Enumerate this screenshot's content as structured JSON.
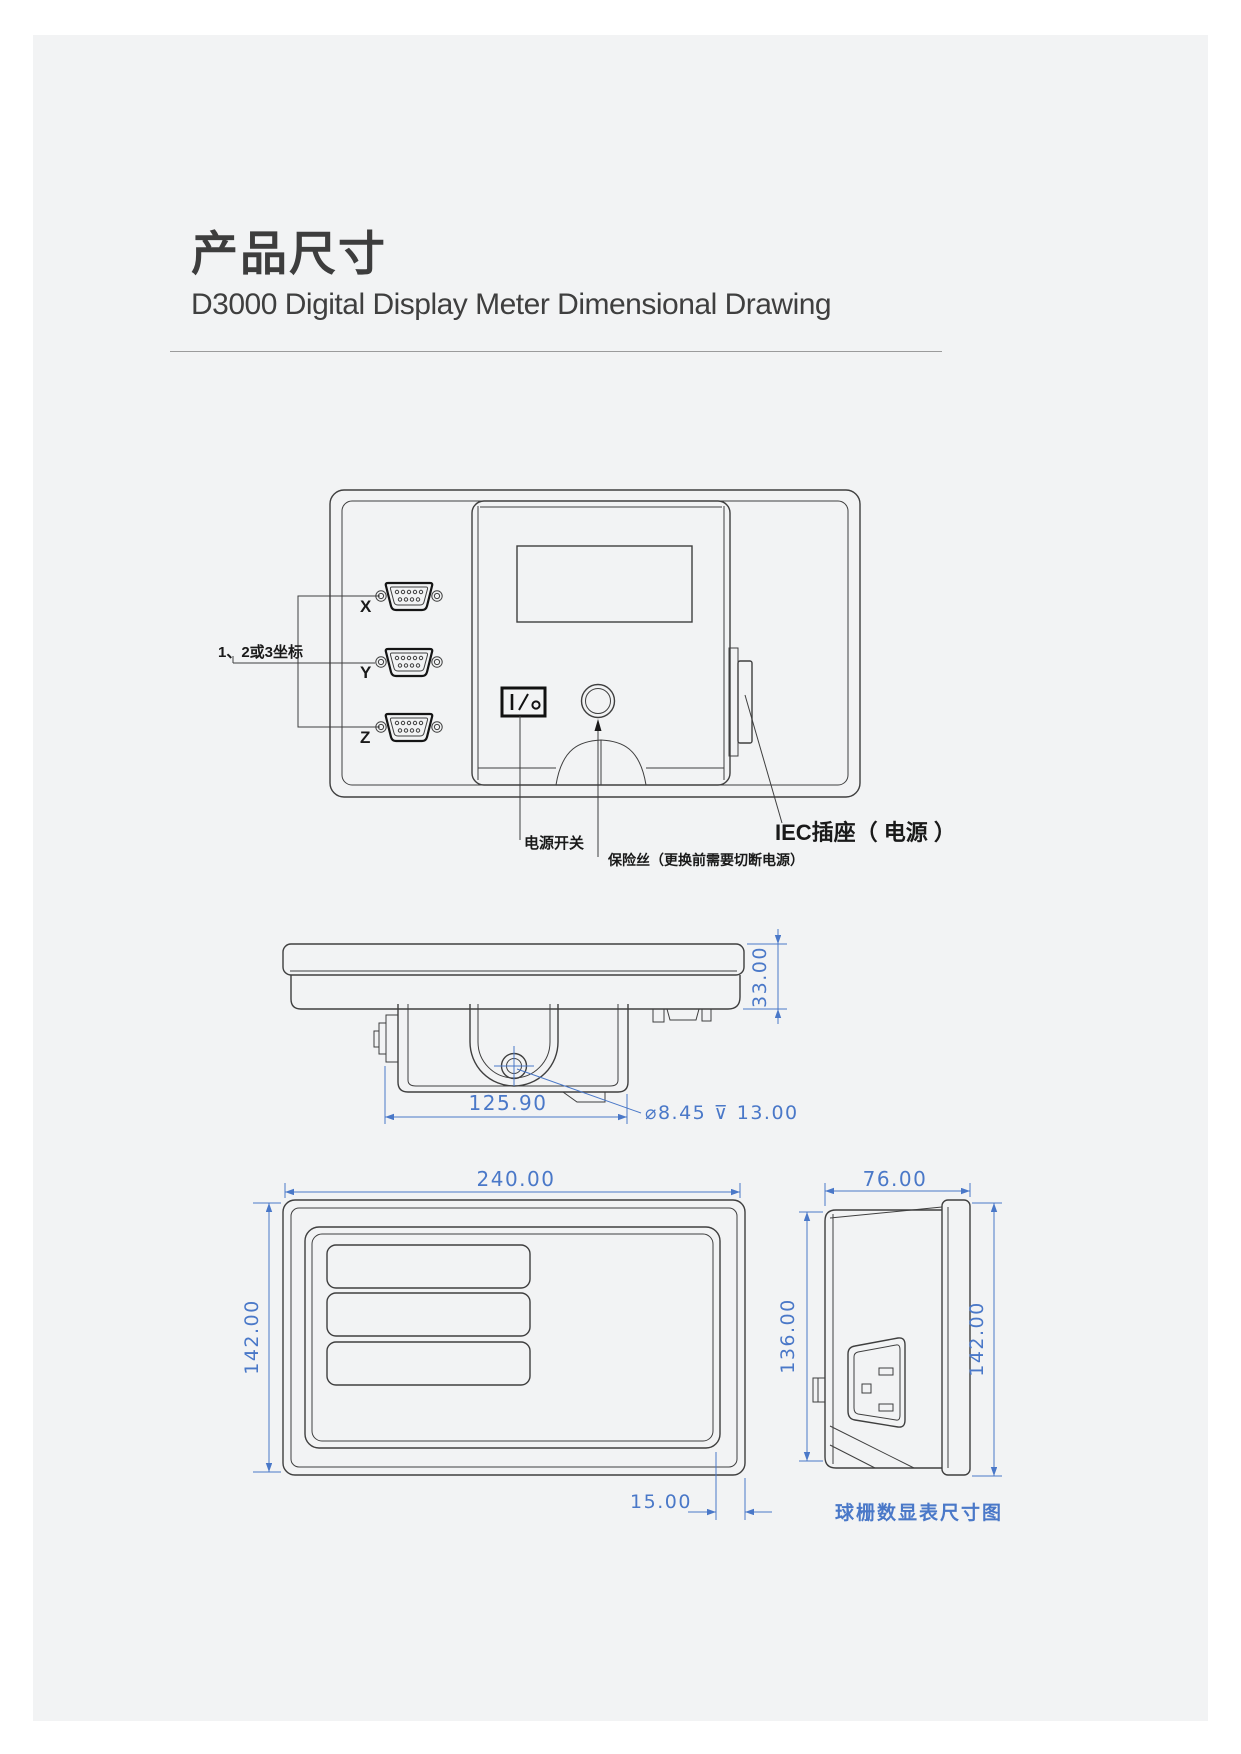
{
  "header": {
    "title": "产品尺寸",
    "subtitle": "D3000 Digital Display Meter Dimensional Drawing"
  },
  "back_view": {
    "bracket_label": "1、2或3坐标",
    "connector_x": "X",
    "connector_y": "Y",
    "connector_z": "Z",
    "power_switch_label": "电源开关",
    "fuse_label": "保险丝（更换前需要切断电源）",
    "iec_label": "IEC插座（ 电源 ）"
  },
  "top_view": {
    "height_dim": "33.00",
    "width_dim": "125.90",
    "hole_note": "⌀8.45 ⊽ 13.00"
  },
  "front_view": {
    "width_dim": "240.00",
    "height_dim": "142.00",
    "inset_dim": "15.00"
  },
  "side_view": {
    "depth_dim": "76.00",
    "body_height_dim": "136.00",
    "overall_height_dim": "142.00",
    "caption": "球栅数显表尺寸图"
  },
  "colors": {
    "dimension_blue": "#4a78c8",
    "line_dark": "#3f3f3f",
    "background": "#f2f3f4"
  }
}
